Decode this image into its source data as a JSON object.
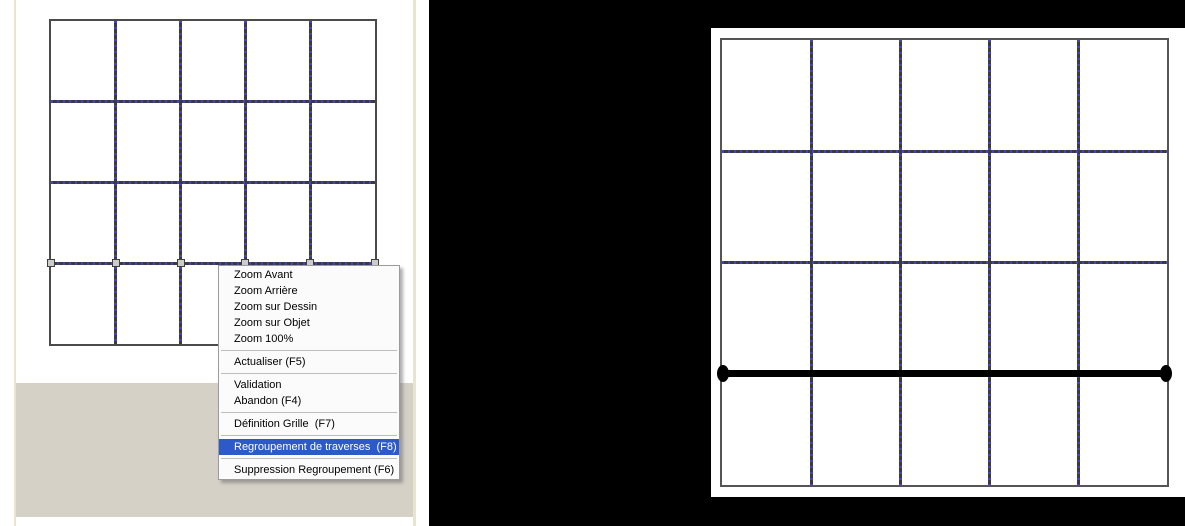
{
  "app": {
    "description_left_view": "drawing canvas with 5x4 grid and selected traverse line",
    "description_right_view": "result canvas with grouped traverse shown as thick bar"
  },
  "context_menu": {
    "items": [
      {
        "label": "Zoom Avant"
      },
      {
        "label": "Zoom Arrière"
      },
      {
        "label": "Zoom sur Dessin"
      },
      {
        "label": "Zoom sur Objet"
      },
      {
        "label": "Zoom 100%"
      },
      {
        "separator": true
      },
      {
        "label": "Actualiser (F5)"
      },
      {
        "separator": true
      },
      {
        "label": "Validation"
      },
      {
        "label": "Abandon (F4)"
      },
      {
        "separator": true
      },
      {
        "label": "Définition Grille  (F7)"
      },
      {
        "separator": true
      },
      {
        "label": "Regroupement de traverses  (F8)",
        "highlighted": true
      },
      {
        "separator": true
      },
      {
        "label": "Suppression Regroupement (F6)"
      }
    ]
  },
  "left_view": {
    "grid": {
      "columns": 5,
      "rows": 4,
      "selected_horizontal_line_index": 3,
      "handle_count": 6
    }
  },
  "right_view": {
    "grid": {
      "columns": 5,
      "rows": 4,
      "grouped_traverse_line_index": 3
    }
  },
  "colors": {
    "menu_highlight": "#2d5ac9",
    "menu_highlight_text": "#ffffff",
    "menu_background": "#fbfbfb",
    "grid_border": "#4a4a4a",
    "grid_dash_blue": "#4343bf",
    "grid_dash_dark": "#3b3b3b",
    "workspace_gray": "#d5d1c7",
    "frame_beige": "#e8e4d4",
    "traverse_black": "#000000"
  }
}
